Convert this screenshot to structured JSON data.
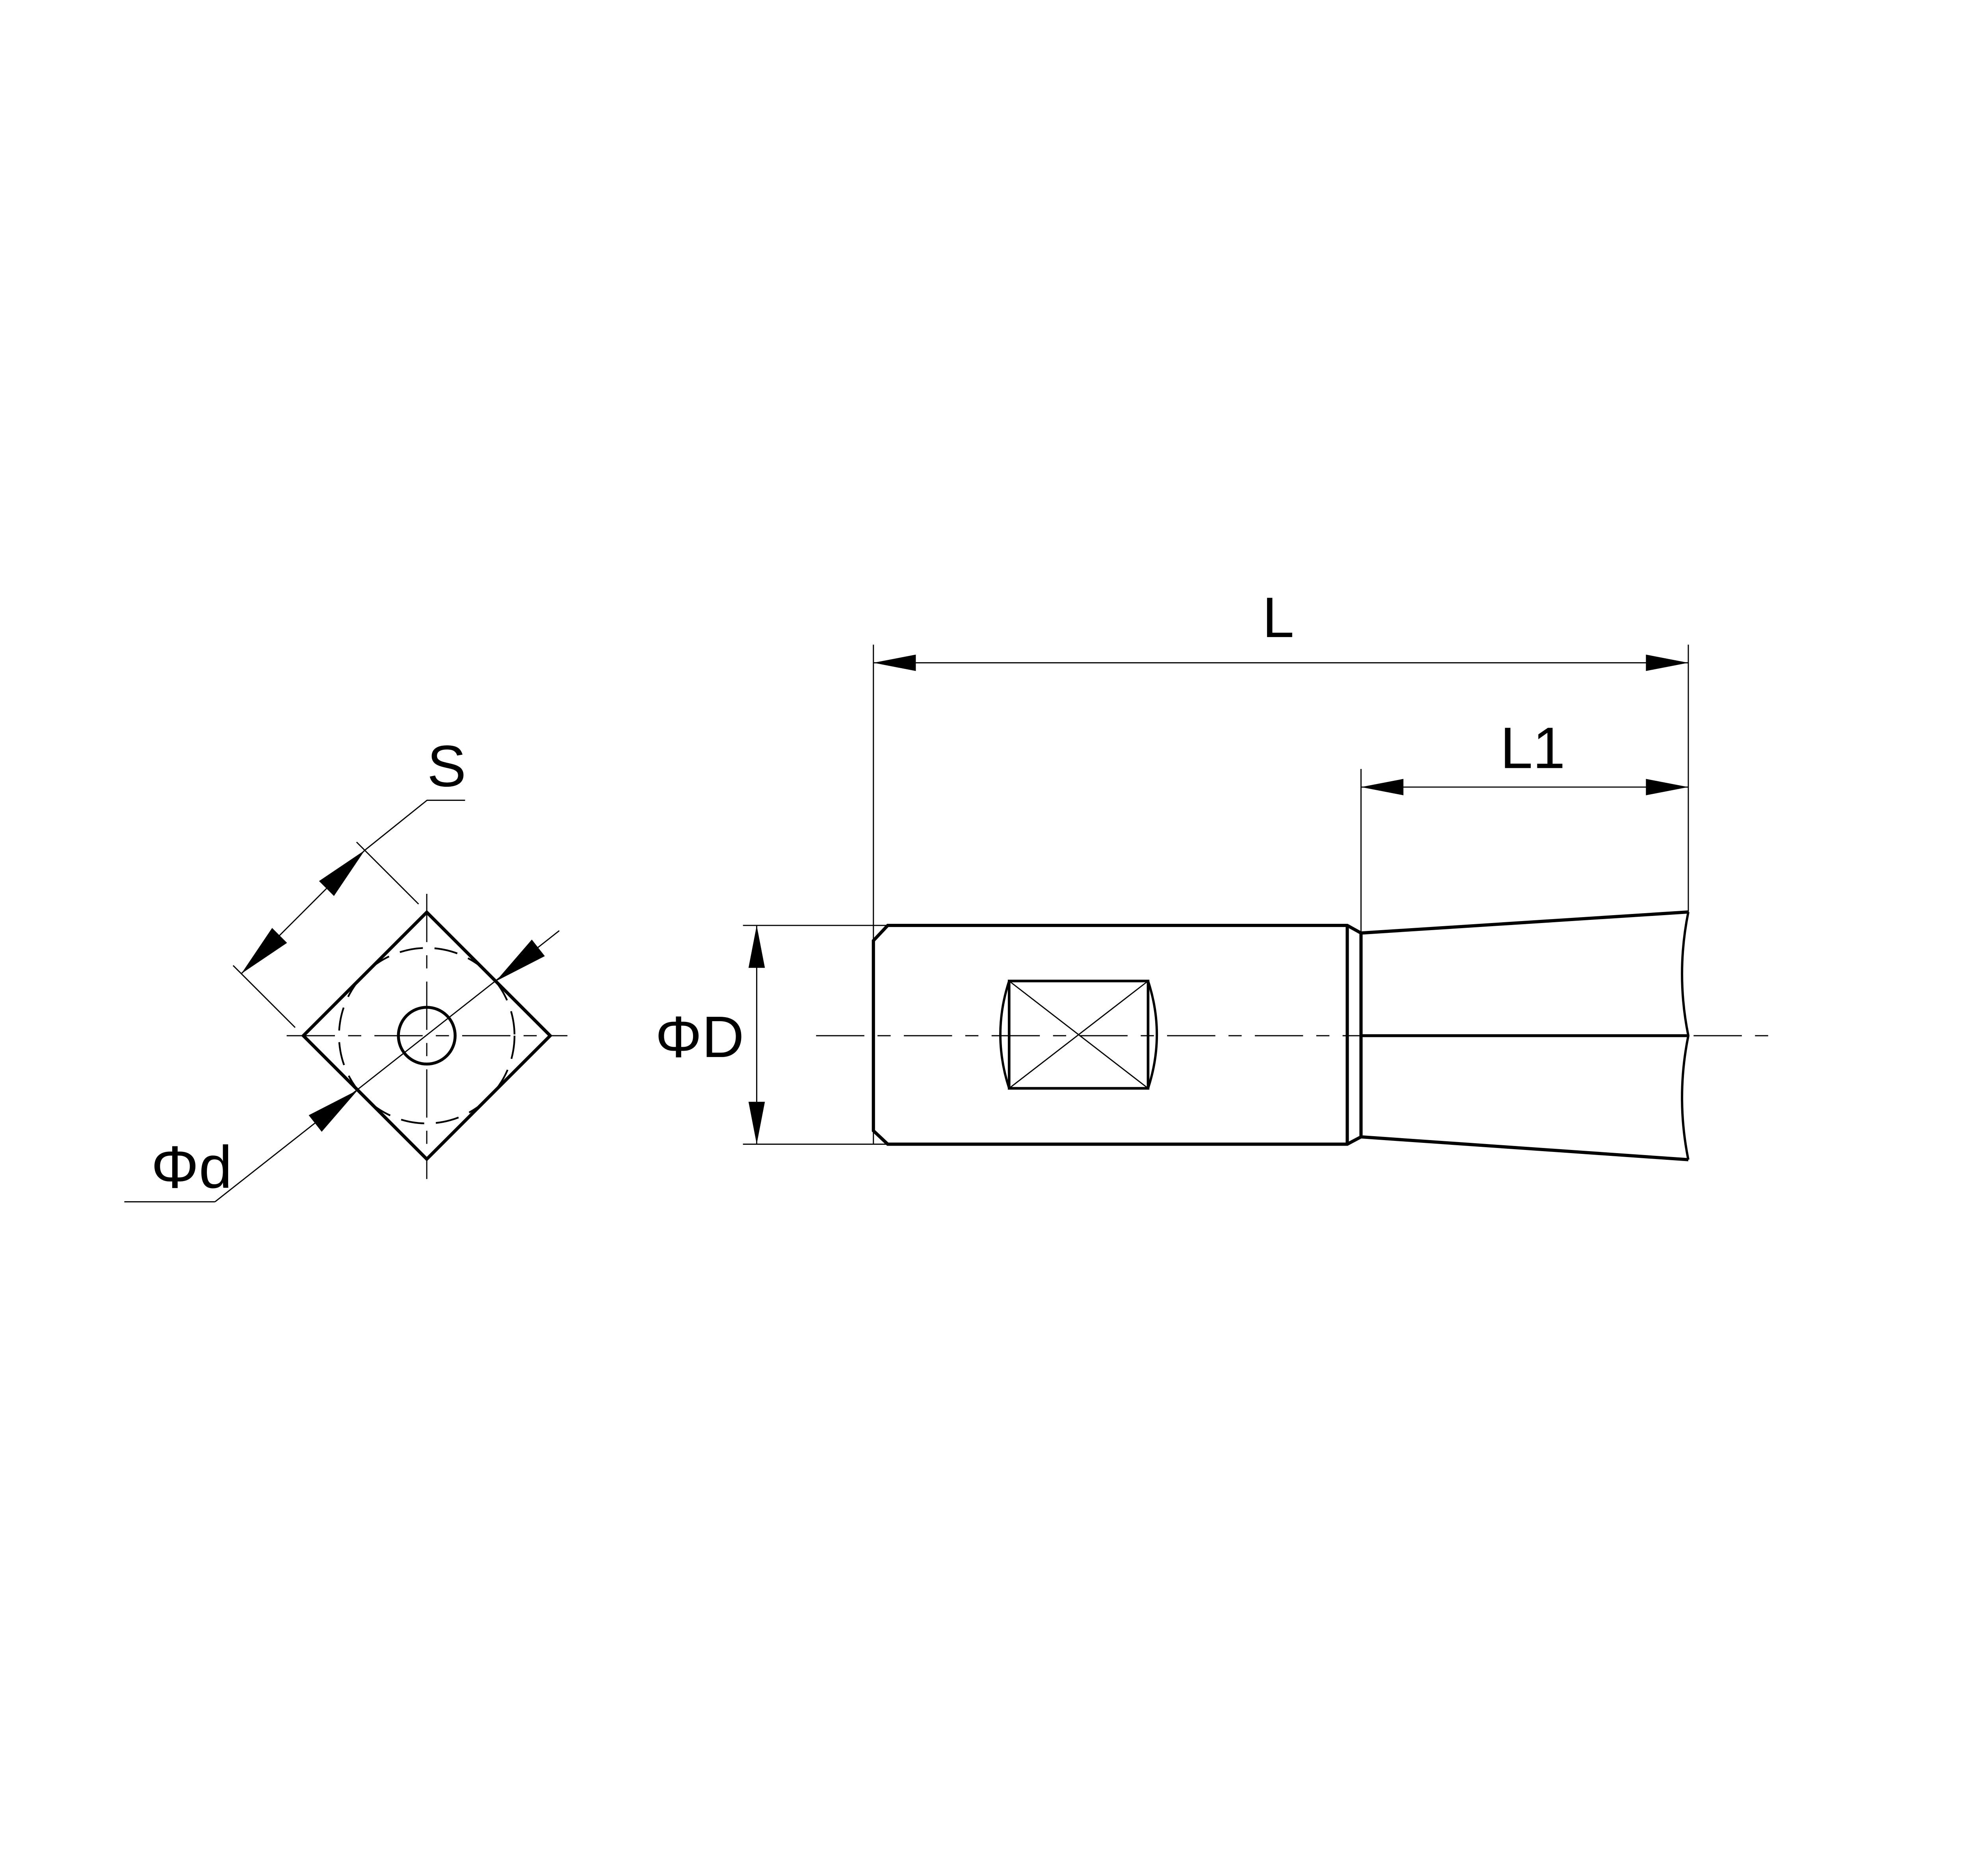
{
  "drawing": {
    "kind": "engineering-drawing",
    "background_color": "#ffffff",
    "line_color": "#000000",
    "views": {
      "end_view": {
        "description": "end view: square crimp section with inscribed dashed circle and center hole",
        "labels": {
          "side_length": "S",
          "inscribed_diameter": "Φd"
        }
      },
      "side_view": {
        "description": "side view: chamfered barrel with crimp window and flared broken-off end",
        "labels": {
          "outer_diameter": "ΦD",
          "overall_length": "L",
          "flare_length": "L1"
        }
      }
    }
  }
}
